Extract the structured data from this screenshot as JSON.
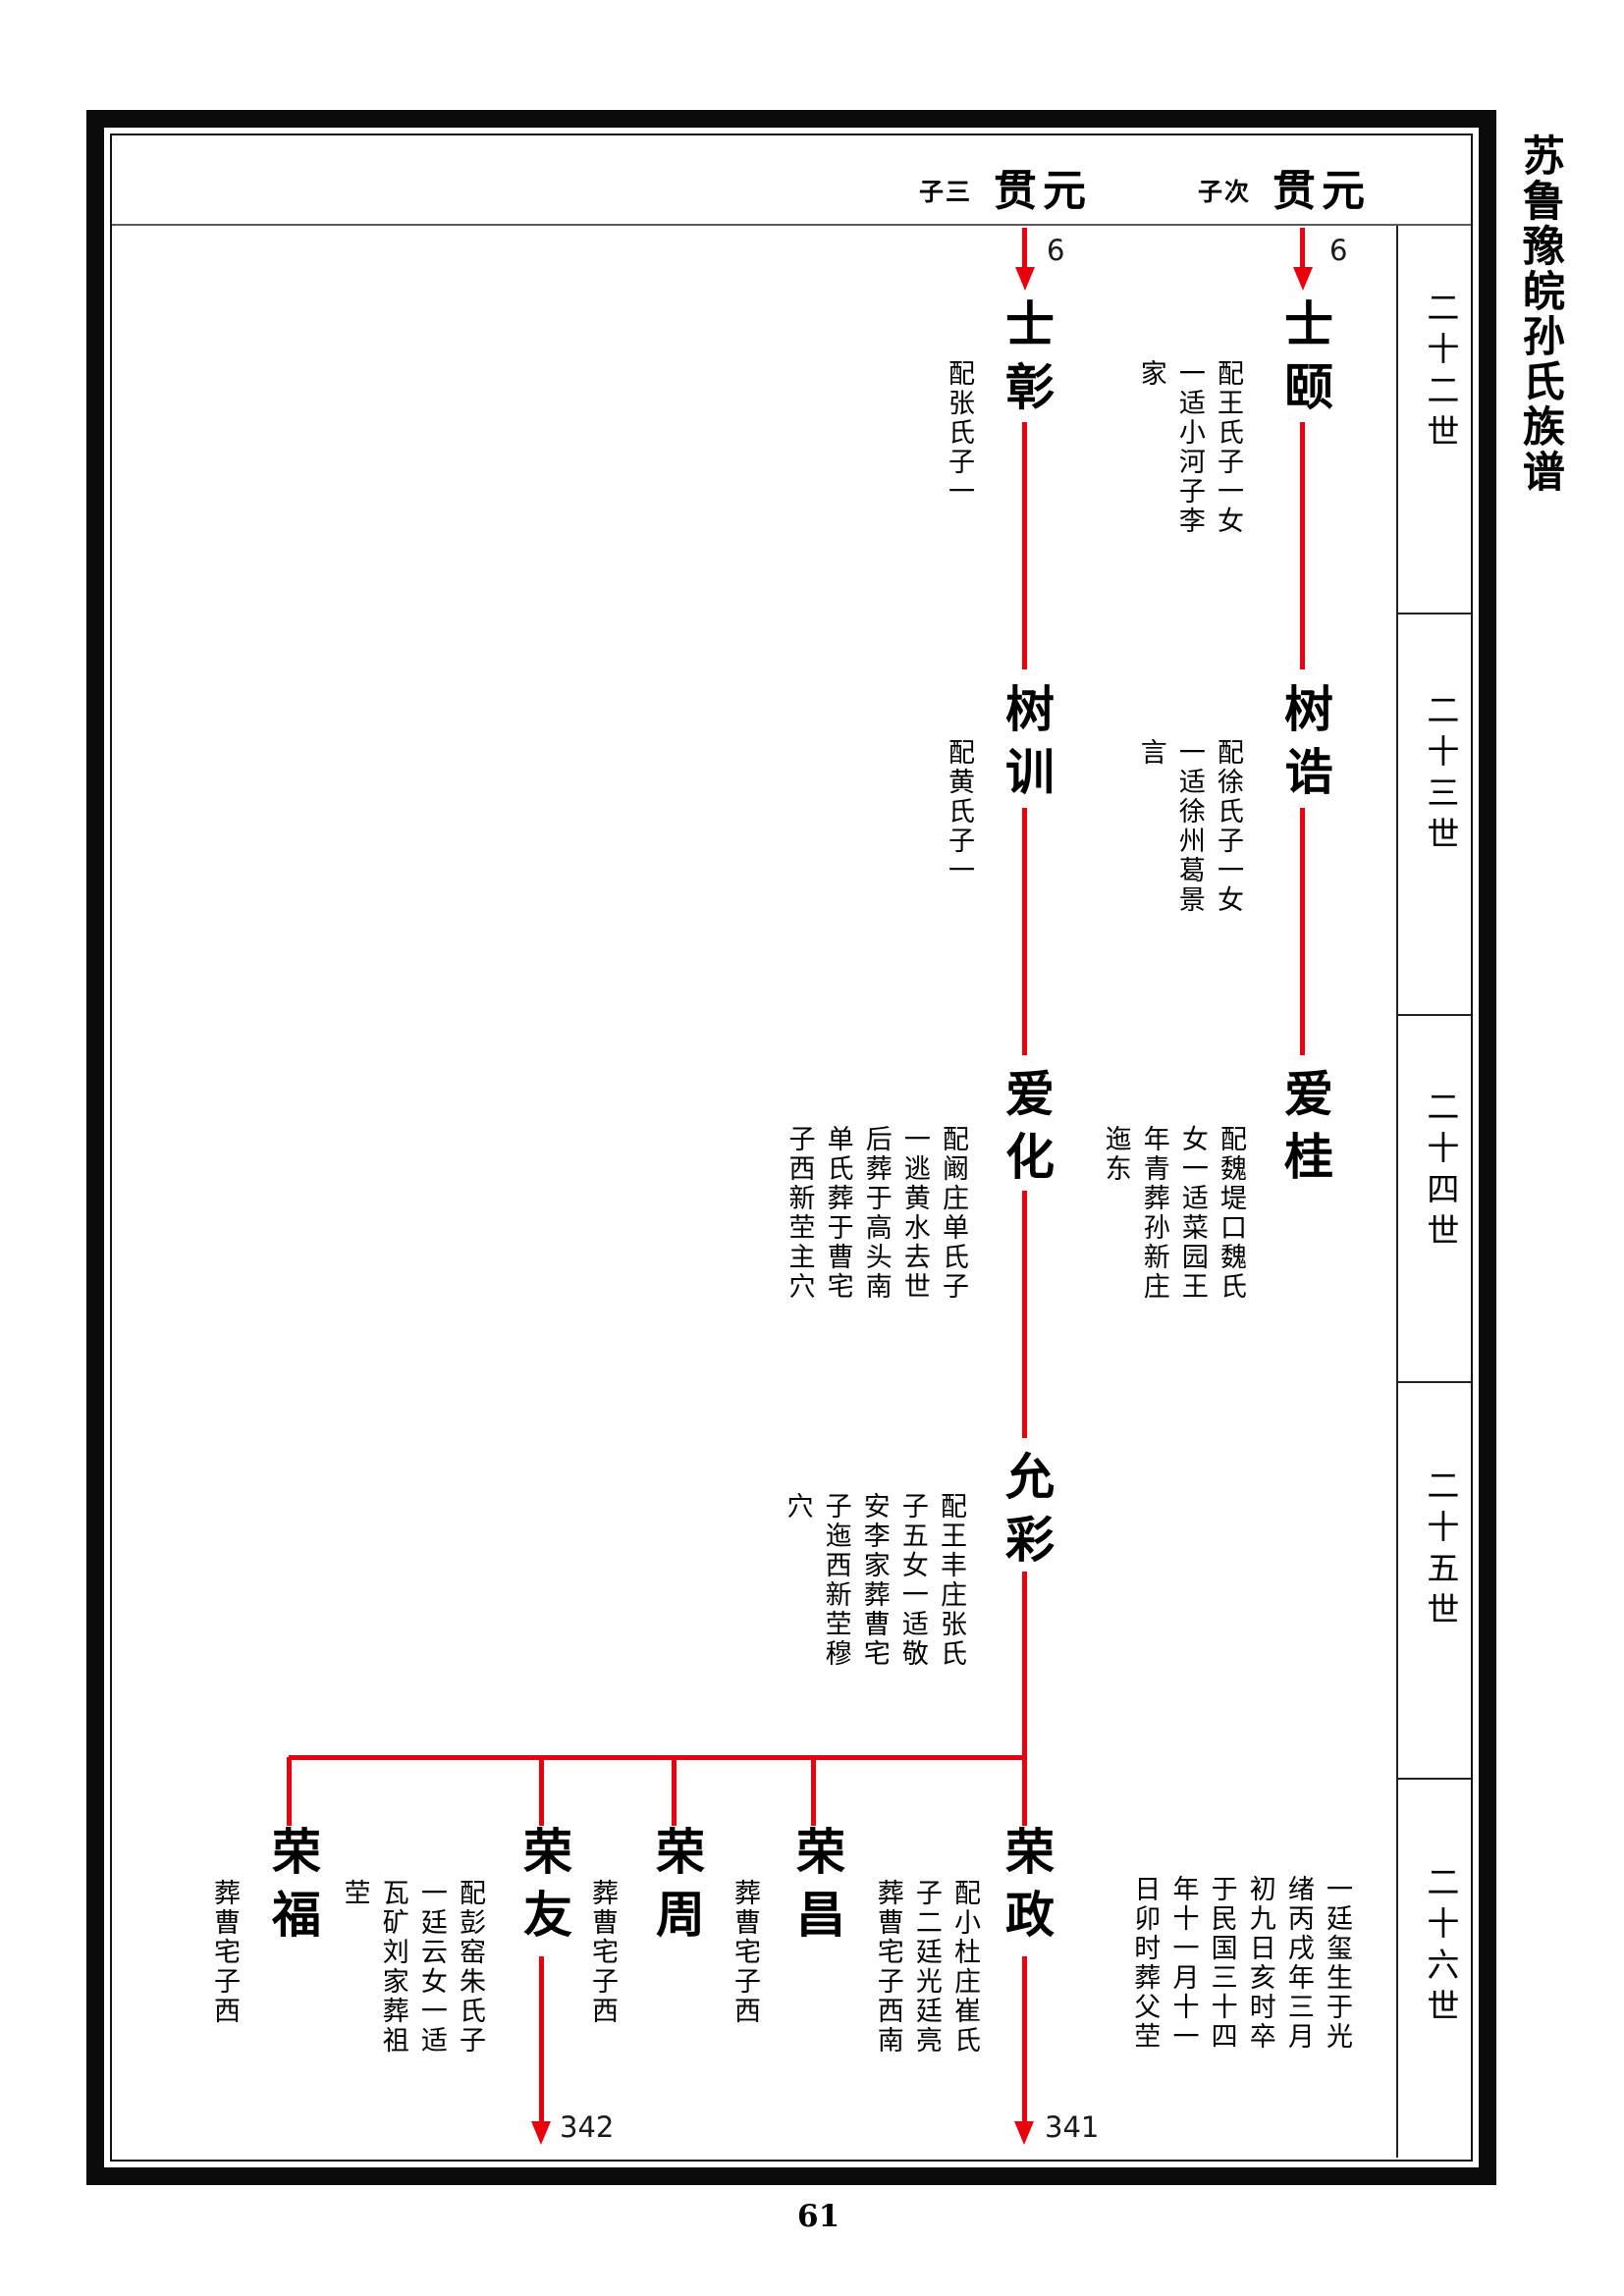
{
  "book_title": "苏鲁豫皖孙氏族谱",
  "page_number": "61",
  "colors": {
    "line_red": "#e8000d"
  },
  "generation_labels": [
    "二十二世",
    "二十三世",
    "二十四世",
    "二十五世",
    "二十六世"
  ],
  "header": {
    "left": {
      "birth_order": "子三",
      "name": "贯元",
      "ref": "6"
    },
    "right": {
      "birth_order": "子次",
      "name": "贯元",
      "ref": "6"
    }
  },
  "lineage_left": [
    {
      "name": "士彰",
      "note": "配张氏子一"
    },
    {
      "name": "树训",
      "note": "配黄氏子一"
    },
    {
      "name": "爱化",
      "note": "配阚庄单氏子一逃黄水去世后葬于高头南单氏葬于曹宅子西新茔主穴"
    },
    {
      "name": "允彩",
      "note": "配王丰庄张氏子五女一适敬安李家葬曹宅子迤西新茔穆穴"
    }
  ],
  "lineage_right": [
    {
      "name": "士颐",
      "note": "配王氏子一女一适小河子李家"
    },
    {
      "name": "树诰",
      "note": "配徐氏子一女一适徐州葛景言"
    },
    {
      "name": "爱桂",
      "note": "配魏堤口魏氏女一适菜园王年青葬孙新庄迤东"
    }
  ],
  "children_row": [
    {
      "name": "荣福",
      "note": "葬曹宅子西"
    },
    {
      "name": "荣友",
      "note": "配彭窑朱氏子一廷云女一适瓦矿刘家葬祖茔",
      "ref": "342"
    },
    {
      "name": "荣周",
      "note": "葬曹宅子西"
    },
    {
      "name": "荣昌",
      "note": "葬曹宅子西"
    },
    {
      "name": "荣政",
      "note": "配小杜庄崔氏子二廷光廷亮葬曹宅子西南",
      "note_right": "一廷玺生于光绪丙戌年三月初九日亥时卒于民国三十四年十一月十一日卯时葬父茔",
      "ref": "341"
    }
  ]
}
